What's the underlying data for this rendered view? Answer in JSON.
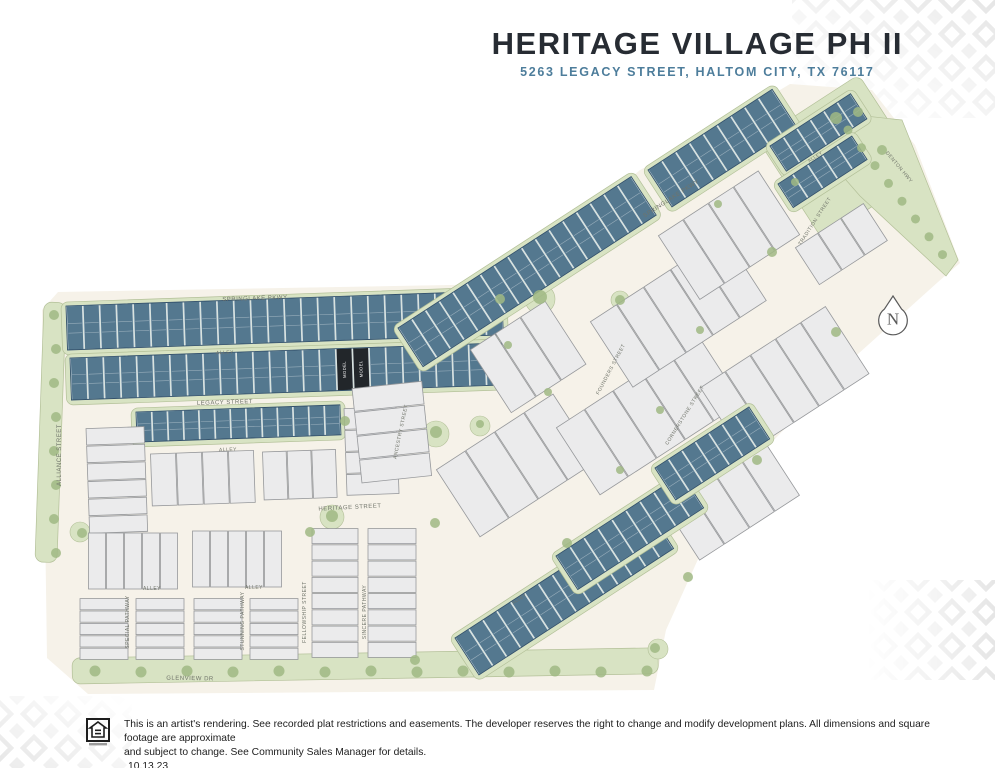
{
  "header": {
    "title": "HERITAGE VILLAGE PH II",
    "subtitle": "5263 LEGACY STREET, HALTOM CITY, TX 76117"
  },
  "footer": {
    "disclaimer1": "This is an artist's rendering. See recorded plat restrictions and easements.  The developer reserves the right to change and modify development plans.  All dimensions and square footage are approximate",
    "disclaimer2": "and subject to change. See Community Sales Manager for details.",
    "date": "10.13.23"
  },
  "map": {
    "north_label": "N",
    "model_label": "MODEL",
    "colors": {
      "site": "#f6f2e9",
      "green": "#d8e3c3",
      "green_border": "#b3c098",
      "tree": "#a0b884",
      "lot_blue": "#54788f",
      "lot_blue_border": "#31506a",
      "lot_blue_gap": "#d9e3ea",
      "lot_white": "#ebebec",
      "lot_white_border": "#96989b",
      "lot_model": "#22262a",
      "street_label": "#70746a",
      "pattern": "#e6e6e6",
      "north": "#5a5a5a"
    },
    "street_labels": [
      {
        "text": "SPRINGLAKE PKWY",
        "x": 255,
        "y": 300,
        "rot": -2,
        "size": 6
      },
      {
        "text": "ALLEY",
        "x": 225,
        "y": 354,
        "rot": -2,
        "size": 5
      },
      {
        "text": "LEGACY STREET",
        "x": 225,
        "y": 404,
        "rot": -2,
        "size": 6
      },
      {
        "text": "ALLEY",
        "x": 228,
        "y": 451,
        "rot": -2,
        "size": 5
      },
      {
        "text": "HERITAGE STREET",
        "x": 350,
        "y": 509,
        "rot": -3,
        "size": 6
      },
      {
        "text": "ALLIANCE STREET",
        "x": 61,
        "y": 455,
        "rot": -90,
        "size": 6
      },
      {
        "text": "GLENVIEW DR",
        "x": 190,
        "y": 680,
        "rot": 1,
        "size": 6
      },
      {
        "text": "ALLEY",
        "x": 152,
        "y": 590,
        "rot": 0,
        "size": 5
      },
      {
        "text": "ALLEY",
        "x": 254,
        "y": 589,
        "rot": 0,
        "size": 5
      },
      {
        "text": "SPECIAL PATHWAY",
        "x": 129,
        "y": 622,
        "rot": -90,
        "size": 5
      },
      {
        "text": "STUNNING PATHWAY",
        "x": 244,
        "y": 621,
        "rot": -90,
        "size": 5
      },
      {
        "text": "FELLOWSHIP STREET",
        "x": 306,
        "y": 612,
        "rot": -90,
        "size": 5
      },
      {
        "text": "SINCERE PATHWAY",
        "x": 366,
        "y": 612,
        "rot": -90,
        "size": 5
      },
      {
        "text": "ANCESTRY STREET",
        "x": 402,
        "y": 432,
        "rot": -78,
        "size": 5
      },
      {
        "text": "SPRINGLAKE PKWY",
        "x": 672,
        "y": 200,
        "rot": -33,
        "size": 6
      },
      {
        "text": "FOUNDERS STREET",
        "x": 612,
        "y": 370,
        "rot": -62,
        "size": 5
      },
      {
        "text": "CORNERSTONE STREET",
        "x": 686,
        "y": 416,
        "rot": -58,
        "size": 5
      },
      {
        "text": "TRADITION STREET",
        "x": 816,
        "y": 222,
        "rot": -57,
        "size": 5
      },
      {
        "text": "DENTON HWY",
        "x": 898,
        "y": 168,
        "rot": 50,
        "size": 5
      },
      {
        "text": "ALLEY",
        "x": 816,
        "y": 158,
        "rot": -33,
        "size": 4.5
      },
      {
        "text": "ALLEY",
        "x": 520,
        "y": 600,
        "rot": -33,
        "size": 4.5
      }
    ],
    "blocks": [
      {
        "x": 66,
        "y": 306,
        "w": 436,
        "h": 44,
        "rot": -2,
        "type": "blue",
        "lots": 26
      },
      {
        "x": 70,
        "y": 358,
        "w": 432,
        "h": 42,
        "rot": -2,
        "type": "blue",
        "lots": 26,
        "models": [
          16,
          17
        ]
      },
      {
        "x": 136,
        "y": 412,
        "w": 204,
        "h": 30,
        "rot": -2,
        "type": "blue",
        "lots": 13
      },
      {
        "x": 344,
        "y": 408,
        "w": 52,
        "h": 88,
        "rot": -2,
        "type": "white-stack",
        "lots": 4
      },
      {
        "x": 86,
        "y": 428,
        "w": 58,
        "h": 106,
        "rot": -2,
        "type": "white-stack",
        "lots": 6
      },
      {
        "x": 150,
        "y": 454,
        "w": 104,
        "h": 52,
        "rot": -2,
        "type": "white",
        "lots": 4
      },
      {
        "x": 262,
        "y": 452,
        "w": 74,
        "h": 48,
        "rot": -2,
        "type": "white",
        "lots": 3
      },
      {
        "x": 88,
        "y": 533,
        "w": 90,
        "h": 56,
        "rot": 0,
        "type": "white",
        "lots": 5
      },
      {
        "x": 192,
        "y": 531,
        "w": 90,
        "h": 56,
        "rot": 0,
        "type": "white",
        "lots": 5
      },
      {
        "x": 80,
        "y": 598,
        "w": 48,
        "h": 62,
        "rot": 0,
        "type": "white-stack",
        "lots": 5
      },
      {
        "x": 136,
        "y": 598,
        "w": 48,
        "h": 62,
        "rot": 0,
        "type": "white-stack",
        "lots": 5
      },
      {
        "x": 194,
        "y": 598,
        "w": 48,
        "h": 62,
        "rot": 0,
        "type": "white-stack",
        "lots": 5
      },
      {
        "x": 250,
        "y": 598,
        "w": 48,
        "h": 62,
        "rot": 0,
        "type": "white-stack",
        "lots": 5
      },
      {
        "x": 312,
        "y": 528,
        "w": 46,
        "h": 130,
        "rot": 0,
        "type": "white-stack",
        "lots": 8
      },
      {
        "x": 368,
        "y": 528,
        "w": 48,
        "h": 130,
        "rot": 0,
        "type": "white-stack",
        "lots": 8
      },
      {
        "x": 352,
        "y": 388,
        "w": 70,
        "h": 96,
        "rot": -6,
        "type": "white-stack",
        "lots": 4
      },
      {
        "x": 436,
        "y": 470,
        "w": 140,
        "h": 80,
        "rot": -33,
        "type": "white",
        "lots": 4
      },
      {
        "x": 470,
        "y": 350,
        "w": 90,
        "h": 75,
        "rot": -33,
        "type": "white",
        "lots": 3
      },
      {
        "x": 556,
        "y": 428,
        "w": 170,
        "h": 80,
        "rot": -33,
        "type": "white",
        "lots": 5
      },
      {
        "x": 590,
        "y": 322,
        "w": 160,
        "h": 78,
        "rot": -33,
        "type": "white",
        "lots": 5
      },
      {
        "x": 700,
        "y": 388,
        "w": 150,
        "h": 80,
        "rot": -33,
        "type": "white",
        "lots": 5
      },
      {
        "x": 658,
        "y": 236,
        "w": 120,
        "h": 76,
        "rot": -33,
        "type": "white",
        "lots": 4
      },
      {
        "x": 660,
        "y": 500,
        "w": 120,
        "h": 72,
        "rot": -33,
        "type": "white",
        "lots": 4
      },
      {
        "x": 795,
        "y": 248,
        "w": 82,
        "h": 44,
        "rot": -33,
        "type": "white",
        "lots": 3
      },
      {
        "x": 398,
        "y": 328,
        "w": 278,
        "h": 46,
        "rot": -33,
        "type": "blue",
        "lots": 17
      },
      {
        "x": 648,
        "y": 170,
        "w": 148,
        "h": 44,
        "rot": -33,
        "type": "blue",
        "lots": 9
      },
      {
        "x": 770,
        "y": 146,
        "w": 96,
        "h": 30,
        "rot": -33,
        "type": "blue",
        "lots": 6
      },
      {
        "x": 778,
        "y": 184,
        "w": 88,
        "h": 28,
        "rot": -33,
        "type": "blue",
        "lots": 5
      },
      {
        "x": 455,
        "y": 638,
        "w": 232,
        "h": 44,
        "rot": -33,
        "type": "blue",
        "lots": 14
      },
      {
        "x": 556,
        "y": 556,
        "w": 150,
        "h": 40,
        "rot": -33,
        "type": "blue",
        "lots": 9
      },
      {
        "x": 655,
        "y": 468,
        "w": 112,
        "h": 38,
        "rot": -33,
        "type": "blue",
        "lots": 7
      }
    ],
    "site_outline": [
      [
        58,
        292
      ],
      [
        505,
        284
      ],
      [
        640,
        170
      ],
      [
        700,
        138
      ],
      [
        790,
        84
      ],
      [
        872,
        90
      ],
      [
        915,
        145
      ],
      [
        960,
        263
      ],
      [
        938,
        282
      ],
      [
        858,
        354
      ],
      [
        768,
        446
      ],
      [
        704,
        546
      ],
      [
        666,
        630
      ],
      [
        654,
        690
      ],
      [
        88,
        694
      ],
      [
        47,
        658
      ],
      [
        42,
        310
      ]
    ]
  }
}
